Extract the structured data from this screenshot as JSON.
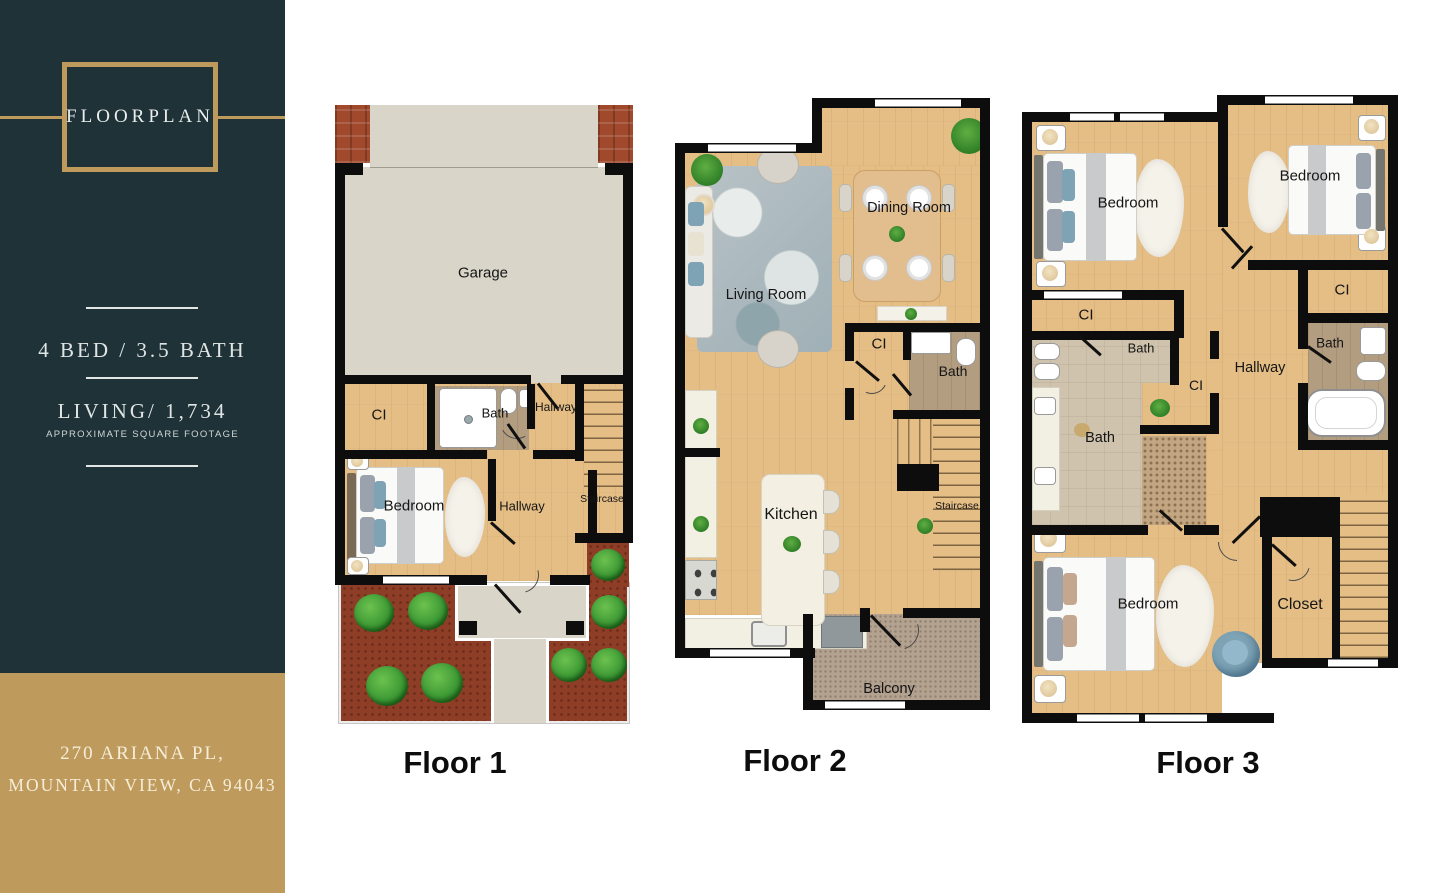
{
  "poster": {
    "sidebar": {
      "logo_text": "FLOORPLAN",
      "spec_line": "4  BED  /  3.5  BATH",
      "living_line": "LIVING/  1,734",
      "living_note": "APPROXIMATE SQUARE FOOTAGE",
      "address_line1": "270 ARIANA PL,",
      "address_line2": "MOUNTAIN VIEW, CA 94043"
    },
    "colors": {
      "sidebar_bg": "#1F3238",
      "gold": "#BE9B5D",
      "wall": "#0D0D0D",
      "wood": "#E5BE86",
      "concrete": "#D9D5C9",
      "tile": "#CFC3AE",
      "tile_dark": "#B39D80",
      "mulch": "#8E3D27",
      "carpet": "#B3A290",
      "bush": "#3E9A35",
      "accent_blue": "#7DA3B5"
    },
    "floors": {
      "floor1": {
        "title": "Floor 1",
        "labels": {
          "garage": "Garage",
          "ci": "CI",
          "bath": "Bath",
          "hallway_upper": "Hallway",
          "hallway_lower": "Hallway",
          "staircase": "Staircase",
          "bedroom": "Bedroom"
        }
      },
      "floor2": {
        "title": "Floor 2",
        "labels": {
          "living_room": "Living Room",
          "dining_room": "Dining Room",
          "ci": "CI",
          "bath": "Bath",
          "kitchen": "Kitchen",
          "staircase": "Staircase",
          "balcony": "Balcony"
        }
      },
      "floor3": {
        "title": "Floor 3",
        "labels": {
          "bedroom_top_left": "Bedroom",
          "bedroom_top_right": "Bedroom",
          "ci_left": "CI",
          "ci_right": "CI",
          "ci_middle": "CI",
          "bath_upper": "Bath",
          "bath_lower": "Bath",
          "bath_right": "Bath",
          "hallway": "Hallway",
          "bedroom_master": "Bedroom",
          "closet": "Closet"
        }
      }
    }
  }
}
